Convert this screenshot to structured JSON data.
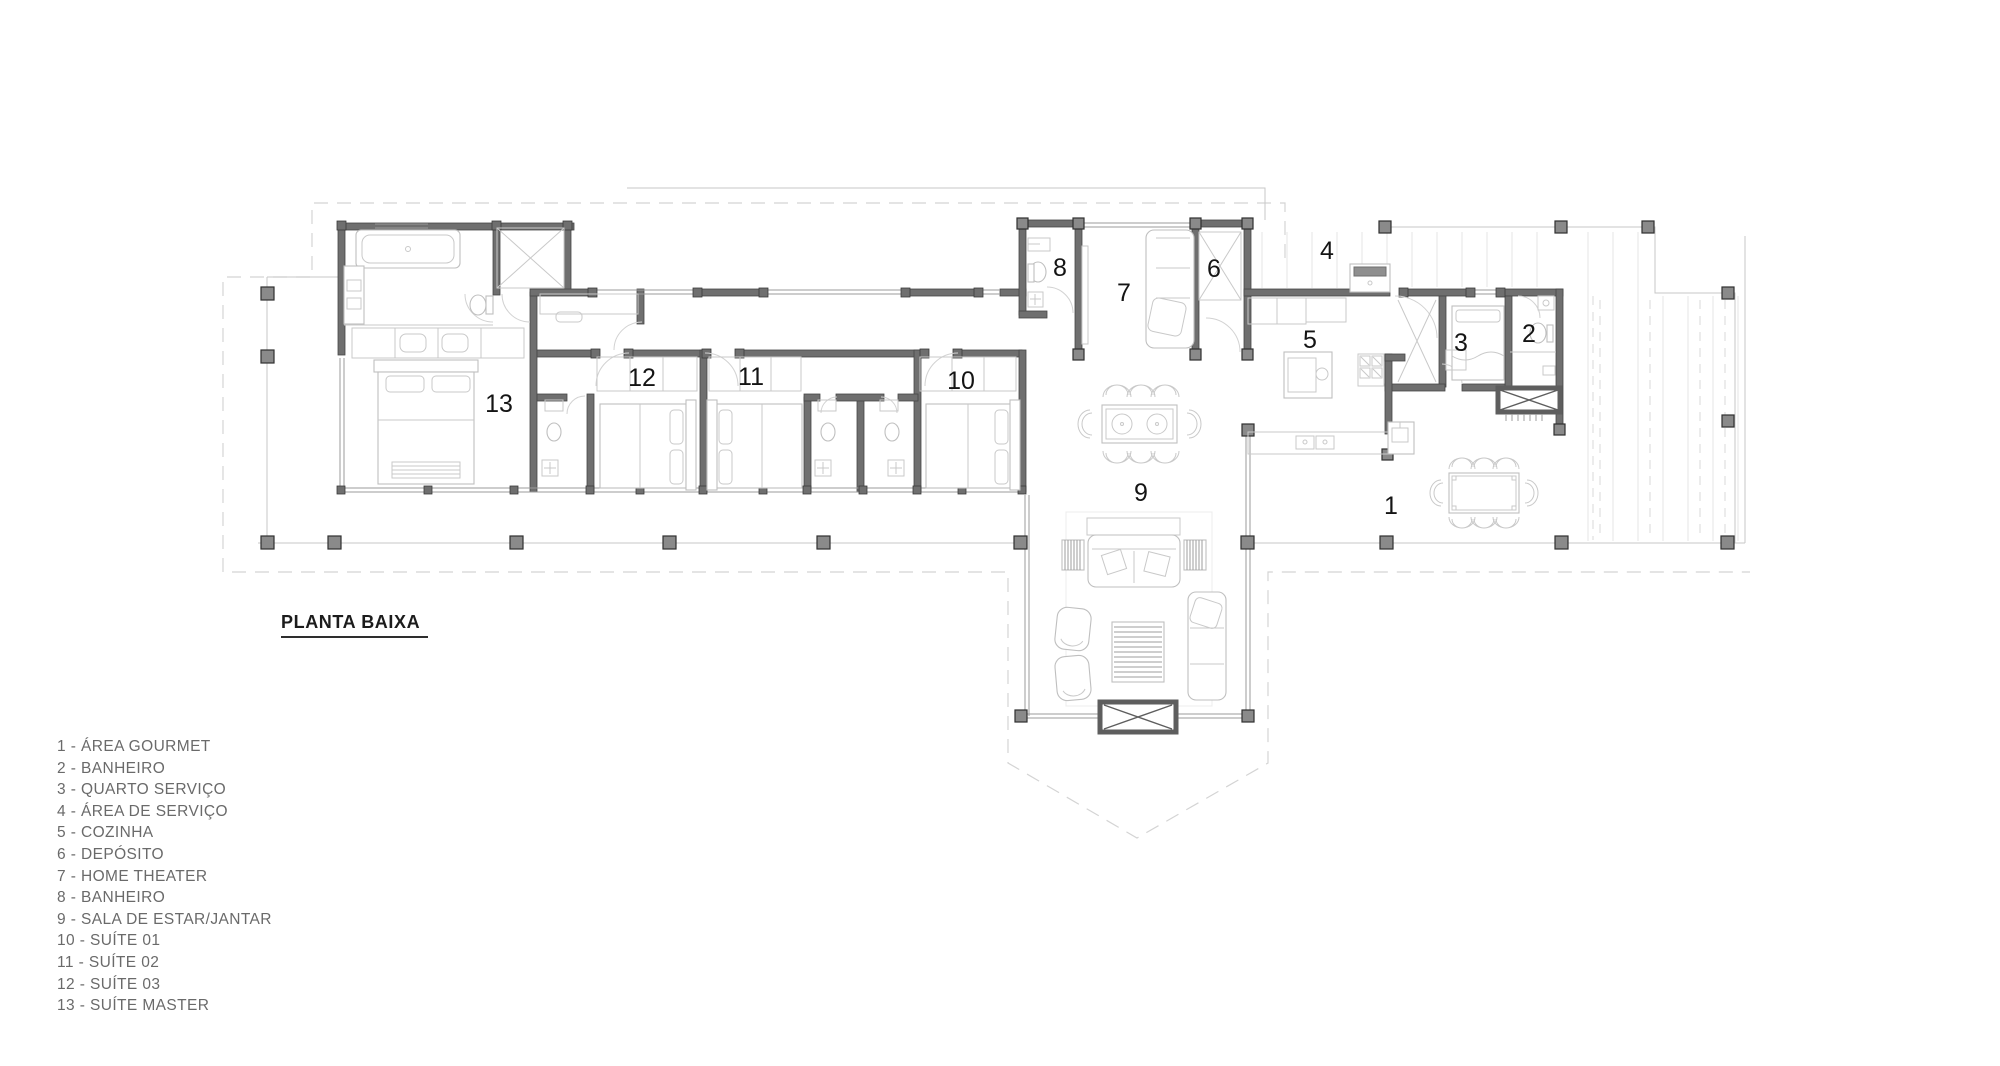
{
  "title": "PLANTA BAIXA",
  "legend": {
    "items": [
      {
        "text": "1 - ÁREA GOURMET"
      },
      {
        "text": "2 - BANHEIRO"
      },
      {
        "text": "3 - QUARTO SERVIÇO"
      },
      {
        "text": "4 - ÁREA DE SERVIÇO"
      },
      {
        "text": "5 - COZINHA"
      },
      {
        "text": "6 - DEPÓSITO"
      },
      {
        "text": "7 - HOME THEATER"
      },
      {
        "text": "8 - BANHEIRO"
      },
      {
        "text": "9 - SALA DE ESTAR/JANTAR"
      },
      {
        "text": "10 - SUÍTE 01"
      },
      {
        "text": "11 - SUÍTE 02"
      },
      {
        "text": "12 - SUÍTE 03"
      },
      {
        "text": "13 - SUÍTE MASTER"
      }
    ]
  },
  "rooms": [
    {
      "num": "1"
    },
    {
      "num": "2"
    },
    {
      "num": "3"
    },
    {
      "num": "4"
    },
    {
      "num": "5"
    },
    {
      "num": "6"
    },
    {
      "num": "7"
    },
    {
      "num": "8"
    },
    {
      "num": "9"
    },
    {
      "num": "10"
    },
    {
      "num": "11"
    },
    {
      "num": "12"
    },
    {
      "num": "13"
    }
  ],
  "colors": {
    "wall": "#6f6f6f",
    "wall_stroke": "#474747",
    "furniture": "#bfbfbf",
    "deck_line": "#c7c7c7",
    "roof_dash": "#d4d4d4",
    "room_label": "#141414",
    "legend_text": "#6a6a6a",
    "title_text": "#1c1c1c"
  }
}
